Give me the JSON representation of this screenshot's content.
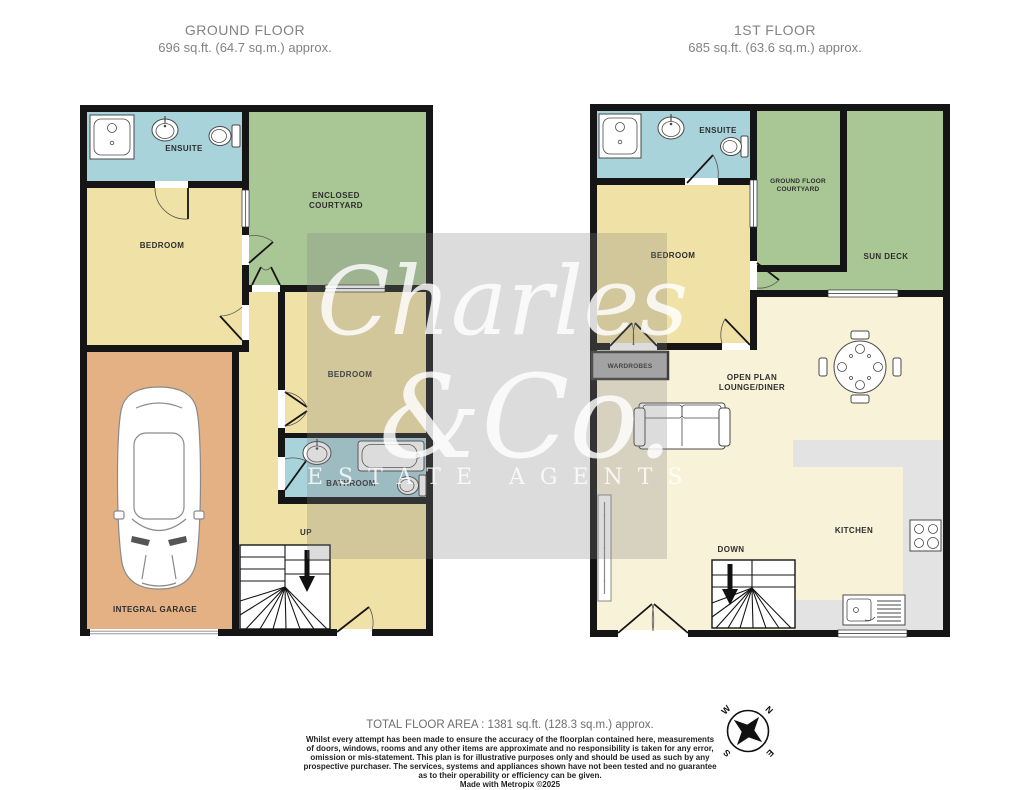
{
  "header_ground": {
    "title": "GROUND FLOOR",
    "area": "696 sq.ft. (64.7 sq.m.) approx."
  },
  "header_first": {
    "title": "1ST FLOOR",
    "area": "685 sq.ft. (63.6 sq.m.) approx."
  },
  "ground": {
    "ensuite": "ENSUITE",
    "courtyard1": "ENCLOSED",
    "courtyard2": "COURTYARD",
    "bedroom1": "BEDROOM",
    "bedroom2": "BEDROOM",
    "bathroom": "BATHROOM",
    "garage": "INTEGRAL GARAGE",
    "up": "UP"
  },
  "first": {
    "ensuite": "ENSUITE",
    "courtyard1": "GROUND FLOOR",
    "courtyard2": "COURTYARD",
    "sundeck": "SUN DECK",
    "bedroom": "BEDROOM",
    "wardrobes": "WARDROBES",
    "lounge1": "OPEN PLAN",
    "lounge2": "LOUNGE/DINER",
    "kitchen": "KITCHEN",
    "down": "DOWN"
  },
  "watermark": {
    "line1": "Charles",
    "line2": "&Co.",
    "line3": "ESTATE AGENTS"
  },
  "compass": {
    "n": "N",
    "e": "E",
    "s": "S",
    "w": "W"
  },
  "footer": {
    "total": "TOTAL FLOOR AREA : 1381 sq.ft. (128.3 sq.m.) approx.",
    "disclaimer": [
      "Whilst every attempt has been made to ensure the accuracy of the floorplan contained here, measurements",
      "of doors, windows, rooms and any other items are approximate and no responsibility is taken for any error,",
      "omission or mis-statement. This plan is for illustrative purposes only and should be used as such by any",
      "prospective purchaser. The services, systems and appliances shown have not been tested and no guarantee",
      "as to their operability or efficiency can be given."
    ],
    "credit": "Made with Metropix ©2025"
  },
  "colors": {
    "room_yellow": "#f0e2a6",
    "courtyard_green": "#a9c795",
    "bath_blue": "#a8d3da",
    "garage_orange": "#e3b183",
    "lounge_cream": "#f8f2d8",
    "counter_grey": "#e3e3e3",
    "wardrobe_grey": "#b0b0b0",
    "wall": "#151515"
  }
}
